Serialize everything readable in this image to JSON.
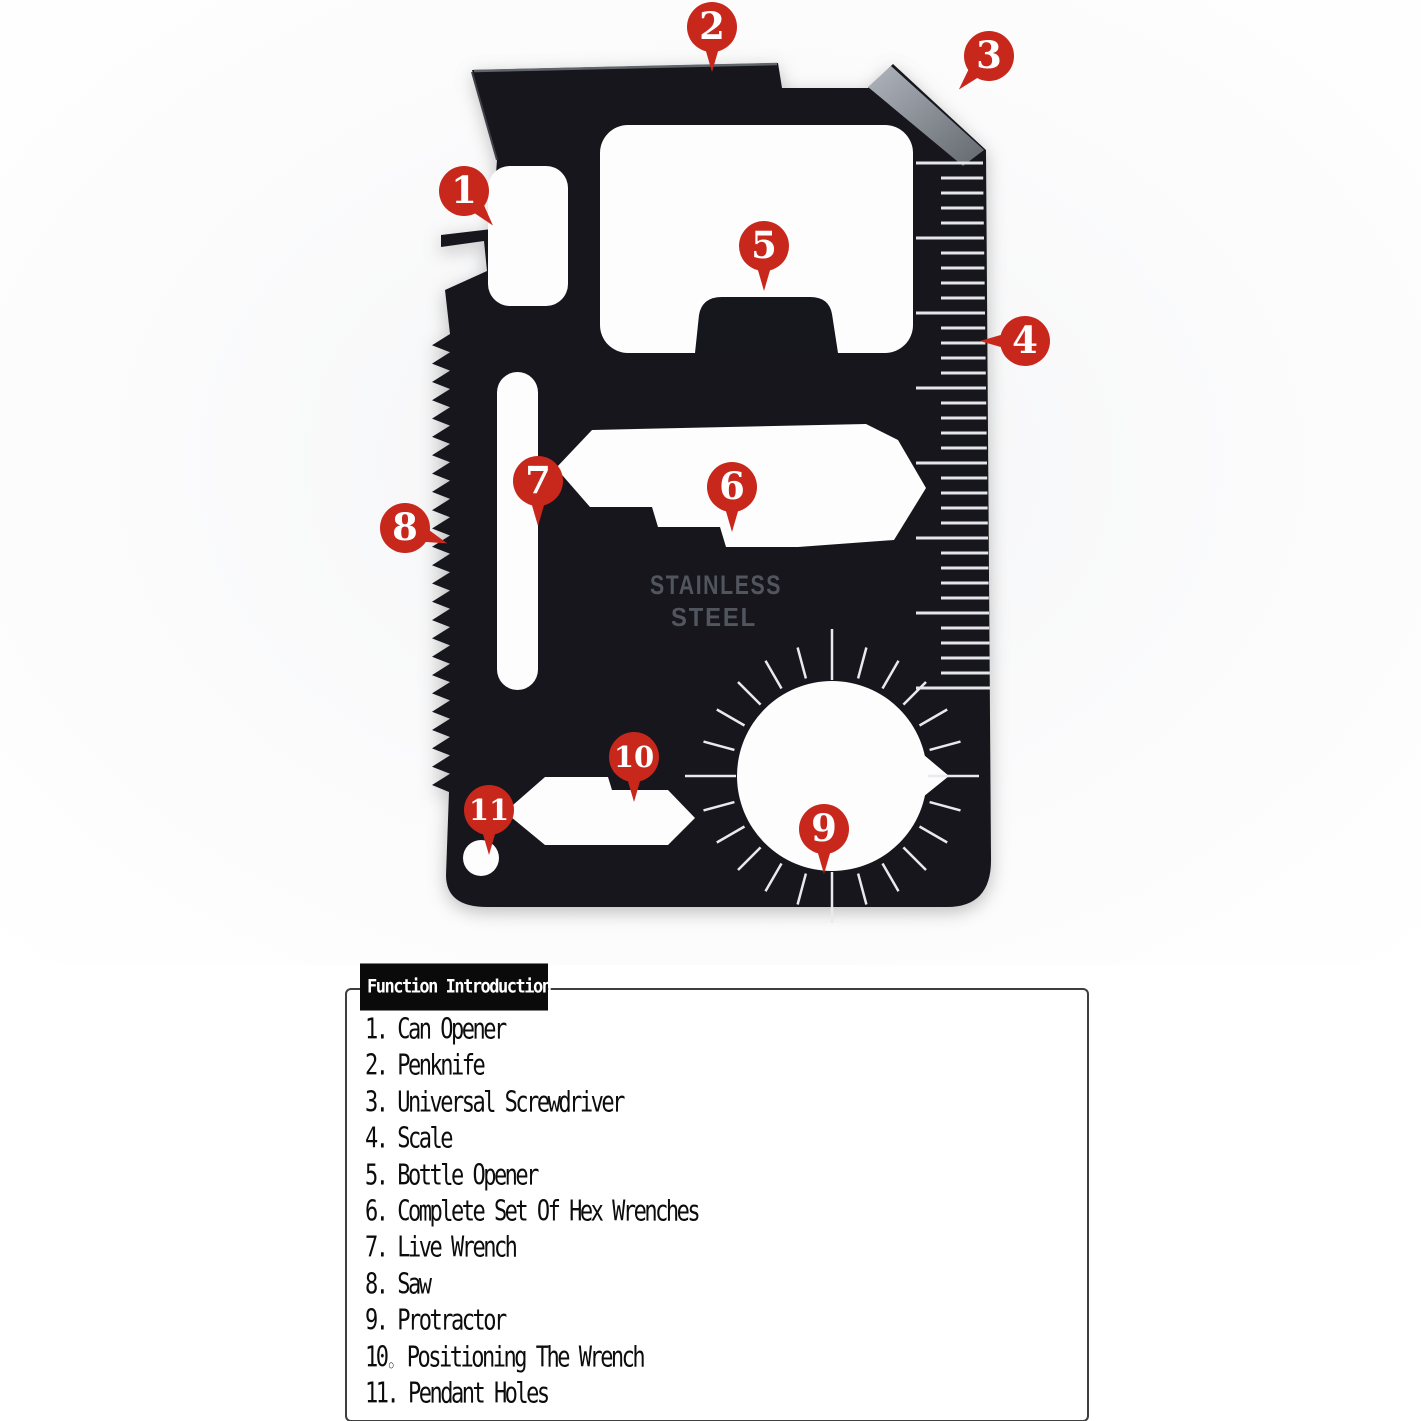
{
  "photo": {
    "engraving_line1": "STAINLESS",
    "engraving_line2": "STEEL",
    "badges": [
      {
        "n": "1",
        "x": 464,
        "y": 191,
        "tail": -40
      },
      {
        "n": "2",
        "x": 712,
        "y": 27,
        "tail": 0
      },
      {
        "n": "3",
        "x": 989,
        "y": 56,
        "tail": 42
      },
      {
        "n": "4",
        "x": 1025,
        "y": 341,
        "tail": 90
      },
      {
        "n": "5",
        "x": 764,
        "y": 246,
        "tail": 0
      },
      {
        "n": "6",
        "x": 732,
        "y": 487,
        "tail": 0
      },
      {
        "n": "7",
        "x": 538,
        "y": 481,
        "tail": 0
      },
      {
        "n": "8",
        "x": 405,
        "y": 528,
        "tail": -70
      },
      {
        "n": "9",
        "x": 824,
        "y": 829,
        "tail": 0
      },
      {
        "n": "10",
        "x": 634,
        "y": 757,
        "tail": 0
      },
      {
        "n": "11",
        "x": 489,
        "y": 810,
        "tail": 0
      }
    ]
  },
  "panel": {
    "title": "Function Introduction",
    "items": [
      "1. Can Opener",
      "2. Penknife",
      "3. Universal Screwdriver",
      "4. Scale",
      "5. Bottle Opener",
      "6. Complete Set Of Hex Wrenches",
      "7. Live Wrench",
      "8. Saw",
      "9. Protractor",
      "10。 Positioning The Wrench",
      "11. Pendant Holes"
    ]
  },
  "colors": {
    "badge_red": "#c8271c",
    "card_black": "#16171c",
    "chamfer_gray": "#8f949c",
    "tick_white": "#e8eaed",
    "engraving_gray": "#565b64",
    "panel_border": "#3f3f3f",
    "title_bg": "#0a0a0a"
  }
}
